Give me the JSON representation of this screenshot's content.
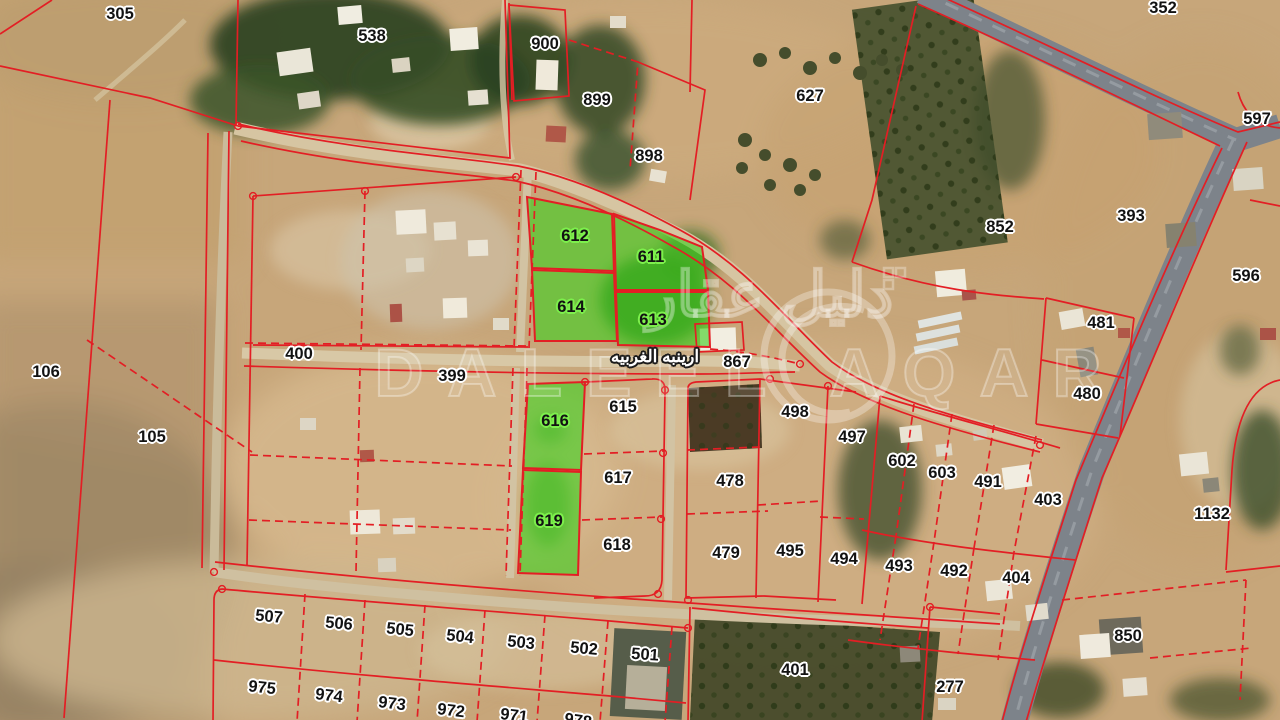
{
  "map": {
    "street_label": "ارينبه الغربيه",
    "watermark": {
      "arabic_text": "دليل عقار",
      "latin_text": "DALEEL AQAR"
    },
    "colors": {
      "parcel_line": "#e31e24",
      "highlight_green": "#3fd020",
      "label_halo_white": "#ffffff",
      "label_halo_green": "#7df04c"
    },
    "highlighted_parcel_numbers": [
      "612",
      "611",
      "614",
      "613",
      "616",
      "619"
    ],
    "parcel_labels": [
      {
        "n": "305",
        "x": 120,
        "y": 14
      },
      {
        "n": "538",
        "x": 372,
        "y": 36
      },
      {
        "n": "900",
        "x": 545,
        "y": 44
      },
      {
        "n": "899",
        "x": 597,
        "y": 100
      },
      {
        "n": "898",
        "x": 649,
        "y": 156
      },
      {
        "n": "627",
        "x": 810,
        "y": 96
      },
      {
        "n": "352",
        "x": 1163,
        "y": 8
      },
      {
        "n": "597",
        "x": 1257,
        "y": 119
      },
      {
        "n": "393",
        "x": 1131,
        "y": 216
      },
      {
        "n": "596",
        "x": 1246,
        "y": 276
      },
      {
        "n": "852",
        "x": 1000,
        "y": 227
      },
      {
        "n": "481",
        "x": 1101,
        "y": 323
      },
      {
        "n": "480",
        "x": 1087,
        "y": 394
      },
      {
        "n": "106",
        "x": 46,
        "y": 372
      },
      {
        "n": "105",
        "x": 152,
        "y": 437
      },
      {
        "n": "400",
        "x": 299,
        "y": 354
      },
      {
        "n": "399",
        "x": 452,
        "y": 376
      },
      {
        "n": "612",
        "x": 575,
        "y": 236,
        "hl": true
      },
      {
        "n": "611",
        "x": 651,
        "y": 257,
        "hl": true
      },
      {
        "n": "614",
        "x": 571,
        "y": 307,
        "hl": true
      },
      {
        "n": "613",
        "x": 653,
        "y": 320,
        "hl": true
      },
      {
        "n": "867",
        "x": 737,
        "y": 362
      },
      {
        "n": "616",
        "x": 555,
        "y": 421,
        "hl": true
      },
      {
        "n": "615",
        "x": 623,
        "y": 407
      },
      {
        "n": "617",
        "x": 618,
        "y": 478
      },
      {
        "n": "619",
        "x": 549,
        "y": 521,
        "hl": true
      },
      {
        "n": "618",
        "x": 617,
        "y": 545
      },
      {
        "n": "478",
        "x": 730,
        "y": 481
      },
      {
        "n": "479",
        "x": 726,
        "y": 553
      },
      {
        "n": "498",
        "x": 795,
        "y": 412
      },
      {
        "n": "497",
        "x": 852,
        "y": 437
      },
      {
        "n": "495",
        "x": 790,
        "y": 551
      },
      {
        "n": "494",
        "x": 844,
        "y": 559
      },
      {
        "n": "602",
        "x": 902,
        "y": 461
      },
      {
        "n": "603",
        "x": 942,
        "y": 473
      },
      {
        "n": "491",
        "x": 988,
        "y": 482
      },
      {
        "n": "403",
        "x": 1048,
        "y": 500
      },
      {
        "n": "1132",
        "x": 1212,
        "y": 514
      },
      {
        "n": "493",
        "x": 899,
        "y": 566
      },
      {
        "n": "492",
        "x": 954,
        "y": 571
      },
      {
        "n": "404",
        "x": 1016,
        "y": 578
      },
      {
        "n": "850",
        "x": 1128,
        "y": 636
      },
      {
        "n": "507",
        "x": 269,
        "y": 617,
        "r": 5
      },
      {
        "n": "506",
        "x": 339,
        "y": 624,
        "r": 5
      },
      {
        "n": "505",
        "x": 400,
        "y": 630,
        "r": 6
      },
      {
        "n": "504",
        "x": 460,
        "y": 637,
        "r": 6
      },
      {
        "n": "503",
        "x": 521,
        "y": 643,
        "r": 6
      },
      {
        "n": "502",
        "x": 584,
        "y": 649,
        "r": 5
      },
      {
        "n": "501",
        "x": 645,
        "y": 655,
        "r": 4
      },
      {
        "n": "975",
        "x": 262,
        "y": 688,
        "r": 6
      },
      {
        "n": "974",
        "x": 329,
        "y": 696,
        "r": 7
      },
      {
        "n": "973",
        "x": 392,
        "y": 704,
        "r": 7
      },
      {
        "n": "972",
        "x": 451,
        "y": 711,
        "r": 7
      },
      {
        "n": "971",
        "x": 514,
        "y": 716,
        "r": 7
      },
      {
        "n": "978",
        "x": 578,
        "y": 721,
        "r": 8
      },
      {
        "n": "401",
        "x": 795,
        "y": 670
      },
      {
        "n": "277",
        "x": 950,
        "y": 687
      }
    ]
  }
}
